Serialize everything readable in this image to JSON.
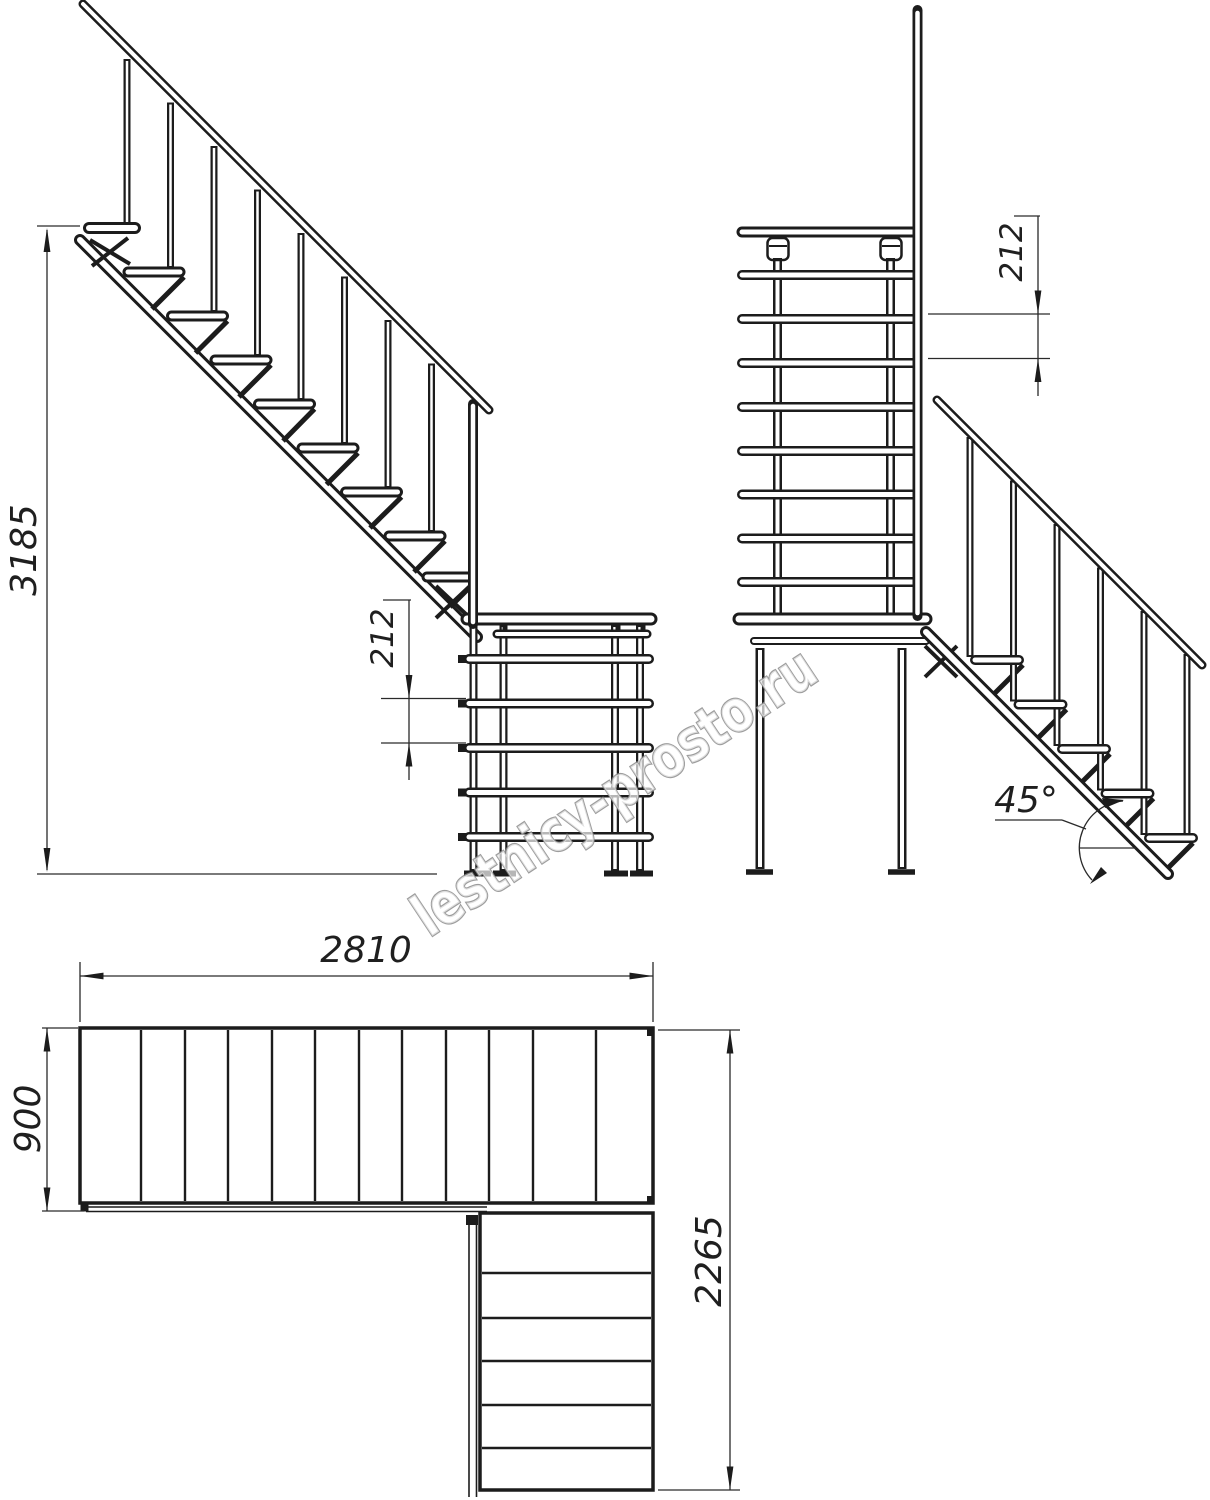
{
  "watermark": {
    "text": "lestnicy-prosto.ru"
  },
  "views": {
    "side_elevation": {
      "label": "side-elevation-of-upper-flight",
      "dims": {
        "total_height": "3185",
        "riser": "212"
      }
    },
    "front_elevation": {
      "label": "front-elevation-with-lower-flight",
      "dims": {
        "riser": "212",
        "angle": "45°"
      }
    },
    "plan": {
      "label": "plan-view",
      "dims": {
        "length": "2810",
        "width": "900",
        "flight_length": "2265"
      }
    }
  },
  "colors": {
    "line": "#1c1c1c",
    "dimension": "#2a2a2a",
    "watermark_outline": "#8c8c8c",
    "background": "#ffffff"
  }
}
